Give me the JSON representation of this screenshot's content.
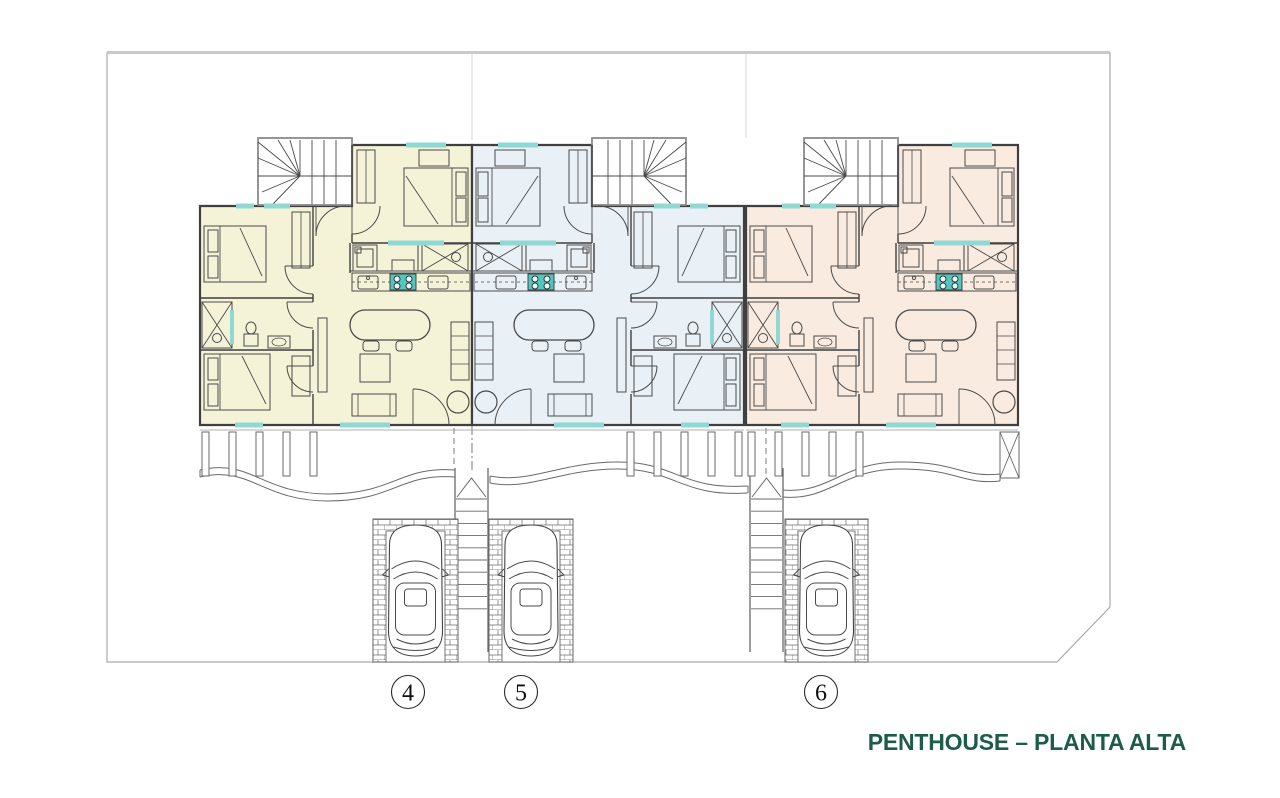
{
  "title": {
    "text": "PENTHOUSE – PLANTA ALTA"
  },
  "units": [
    {
      "number": "4",
      "fill": "#f5f3d7",
      "description": "left penthouse unit, yellow tint"
    },
    {
      "number": "5",
      "fill": "#e9f1f7",
      "description": "middle penthouse unit, blue tint, mirrored layout"
    },
    {
      "number": "6",
      "fill": "#f9ebdf",
      "description": "right penthouse unit, peach tint"
    }
  ],
  "colors": {
    "title_green": "#1d5b4a",
    "wall": "#3f3f3f",
    "furniture": "#4a4a4a",
    "light_line": "#6a6a6a",
    "window_teal": "#8fd8d3",
    "hob_teal": "#52c7c0",
    "boundary": "#aaaaaa",
    "boundary_top": "#c9c9c9",
    "lot_line": "#dcdcdc",
    "stair_border": "#8a8a8a",
    "background": "#ffffff"
  }
}
